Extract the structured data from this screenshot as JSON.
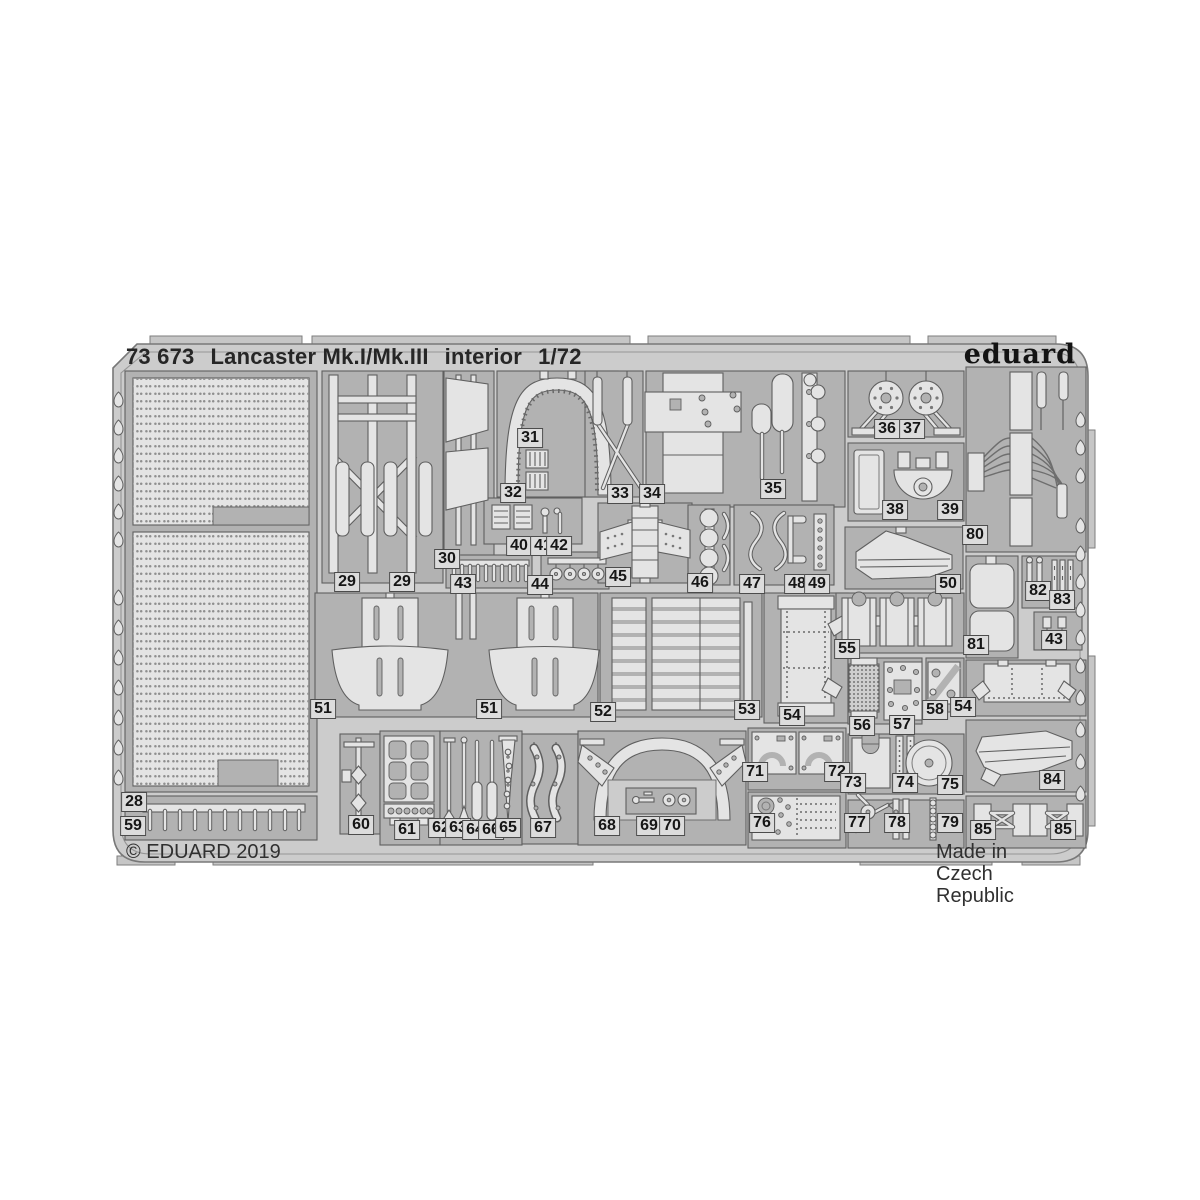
{
  "header": {
    "code": "73 673",
    "title": "Lancaster Mk.I/Mk.III",
    "subtitle": "interior",
    "scale": "1/72",
    "brand": "eduard"
  },
  "footer": {
    "copyright": "© EDUARD 2019",
    "origin": "Made in Czech Republic"
  },
  "colors": {
    "background": "#ffffff",
    "sheet": "#cccccc",
    "recess": "#b2b2b2",
    "part": "#e4e4e4",
    "outline": "#5f5f5f",
    "label_bg": "#dcdcdc"
  },
  "part_labels": [
    {
      "n": "28",
      "x": 134,
      "y": 802
    },
    {
      "n": "29",
      "x": 347,
      "y": 582
    },
    {
      "n": "29",
      "x": 402,
      "y": 582
    },
    {
      "n": "30",
      "x": 447,
      "y": 559
    },
    {
      "n": "31",
      "x": 530,
      "y": 438
    },
    {
      "n": "32",
      "x": 513,
      "y": 493
    },
    {
      "n": "33",
      "x": 620,
      "y": 494
    },
    {
      "n": "34",
      "x": 652,
      "y": 494
    },
    {
      "n": "35",
      "x": 773,
      "y": 489
    },
    {
      "n": "36",
      "x": 887,
      "y": 429
    },
    {
      "n": "37",
      "x": 912,
      "y": 429
    },
    {
      "n": "38",
      "x": 895,
      "y": 510
    },
    {
      "n": "39",
      "x": 950,
      "y": 510
    },
    {
      "n": "40",
      "x": 519,
      "y": 546
    },
    {
      "n": "41",
      "x": 543,
      "y": 546
    },
    {
      "n": "42",
      "x": 559,
      "y": 546
    },
    {
      "n": "43",
      "x": 463,
      "y": 584
    },
    {
      "n": "44",
      "x": 540,
      "y": 585
    },
    {
      "n": "45",
      "x": 618,
      "y": 577
    },
    {
      "n": "46",
      "x": 700,
      "y": 583
    },
    {
      "n": "47",
      "x": 752,
      "y": 584
    },
    {
      "n": "48",
      "x": 797,
      "y": 584
    },
    {
      "n": "49",
      "x": 817,
      "y": 584
    },
    {
      "n": "50",
      "x": 948,
      "y": 584
    },
    {
      "n": "51",
      "x": 323,
      "y": 709
    },
    {
      "n": "51",
      "x": 489,
      "y": 709
    },
    {
      "n": "52",
      "x": 603,
      "y": 712
    },
    {
      "n": "53",
      "x": 747,
      "y": 710
    },
    {
      "n": "54",
      "x": 792,
      "y": 716
    },
    {
      "n": "54",
      "x": 963,
      "y": 707
    },
    {
      "n": "55",
      "x": 847,
      "y": 649
    },
    {
      "n": "56",
      "x": 862,
      "y": 726
    },
    {
      "n": "57",
      "x": 902,
      "y": 725
    },
    {
      "n": "58",
      "x": 935,
      "y": 710
    },
    {
      "n": "59",
      "x": 133,
      "y": 826
    },
    {
      "n": "60",
      "x": 361,
      "y": 825
    },
    {
      "n": "61",
      "x": 407,
      "y": 830
    },
    {
      "n": "62",
      "x": 441,
      "y": 828
    },
    {
      "n": "63",
      "x": 458,
      "y": 828
    },
    {
      "n": "64",
      "x": 475,
      "y": 830
    },
    {
      "n": "66",
      "x": 491,
      "y": 830
    },
    {
      "n": "65",
      "x": 508,
      "y": 828
    },
    {
      "n": "67",
      "x": 543,
      "y": 828
    },
    {
      "n": "68",
      "x": 607,
      "y": 826
    },
    {
      "n": "69",
      "x": 649,
      "y": 826
    },
    {
      "n": "70",
      "x": 672,
      "y": 826
    },
    {
      "n": "71",
      "x": 755,
      "y": 772
    },
    {
      "n": "72",
      "x": 837,
      "y": 772
    },
    {
      "n": "73",
      "x": 853,
      "y": 783
    },
    {
      "n": "74",
      "x": 905,
      "y": 783
    },
    {
      "n": "75",
      "x": 950,
      "y": 785
    },
    {
      "n": "76",
      "x": 762,
      "y": 823
    },
    {
      "n": "77",
      "x": 857,
      "y": 823
    },
    {
      "n": "78",
      "x": 897,
      "y": 823
    },
    {
      "n": "79",
      "x": 950,
      "y": 823
    },
    {
      "n": "80",
      "x": 975,
      "y": 535
    },
    {
      "n": "81",
      "x": 976,
      "y": 645
    },
    {
      "n": "82",
      "x": 1038,
      "y": 591
    },
    {
      "n": "83",
      "x": 1062,
      "y": 600
    },
    {
      "n": "84",
      "x": 1052,
      "y": 780
    },
    {
      "n": "85",
      "x": 983,
      "y": 830
    },
    {
      "n": "85",
      "x": 1063,
      "y": 830
    },
    {
      "n": "43",
      "x": 1054,
      "y": 640
    }
  ]
}
